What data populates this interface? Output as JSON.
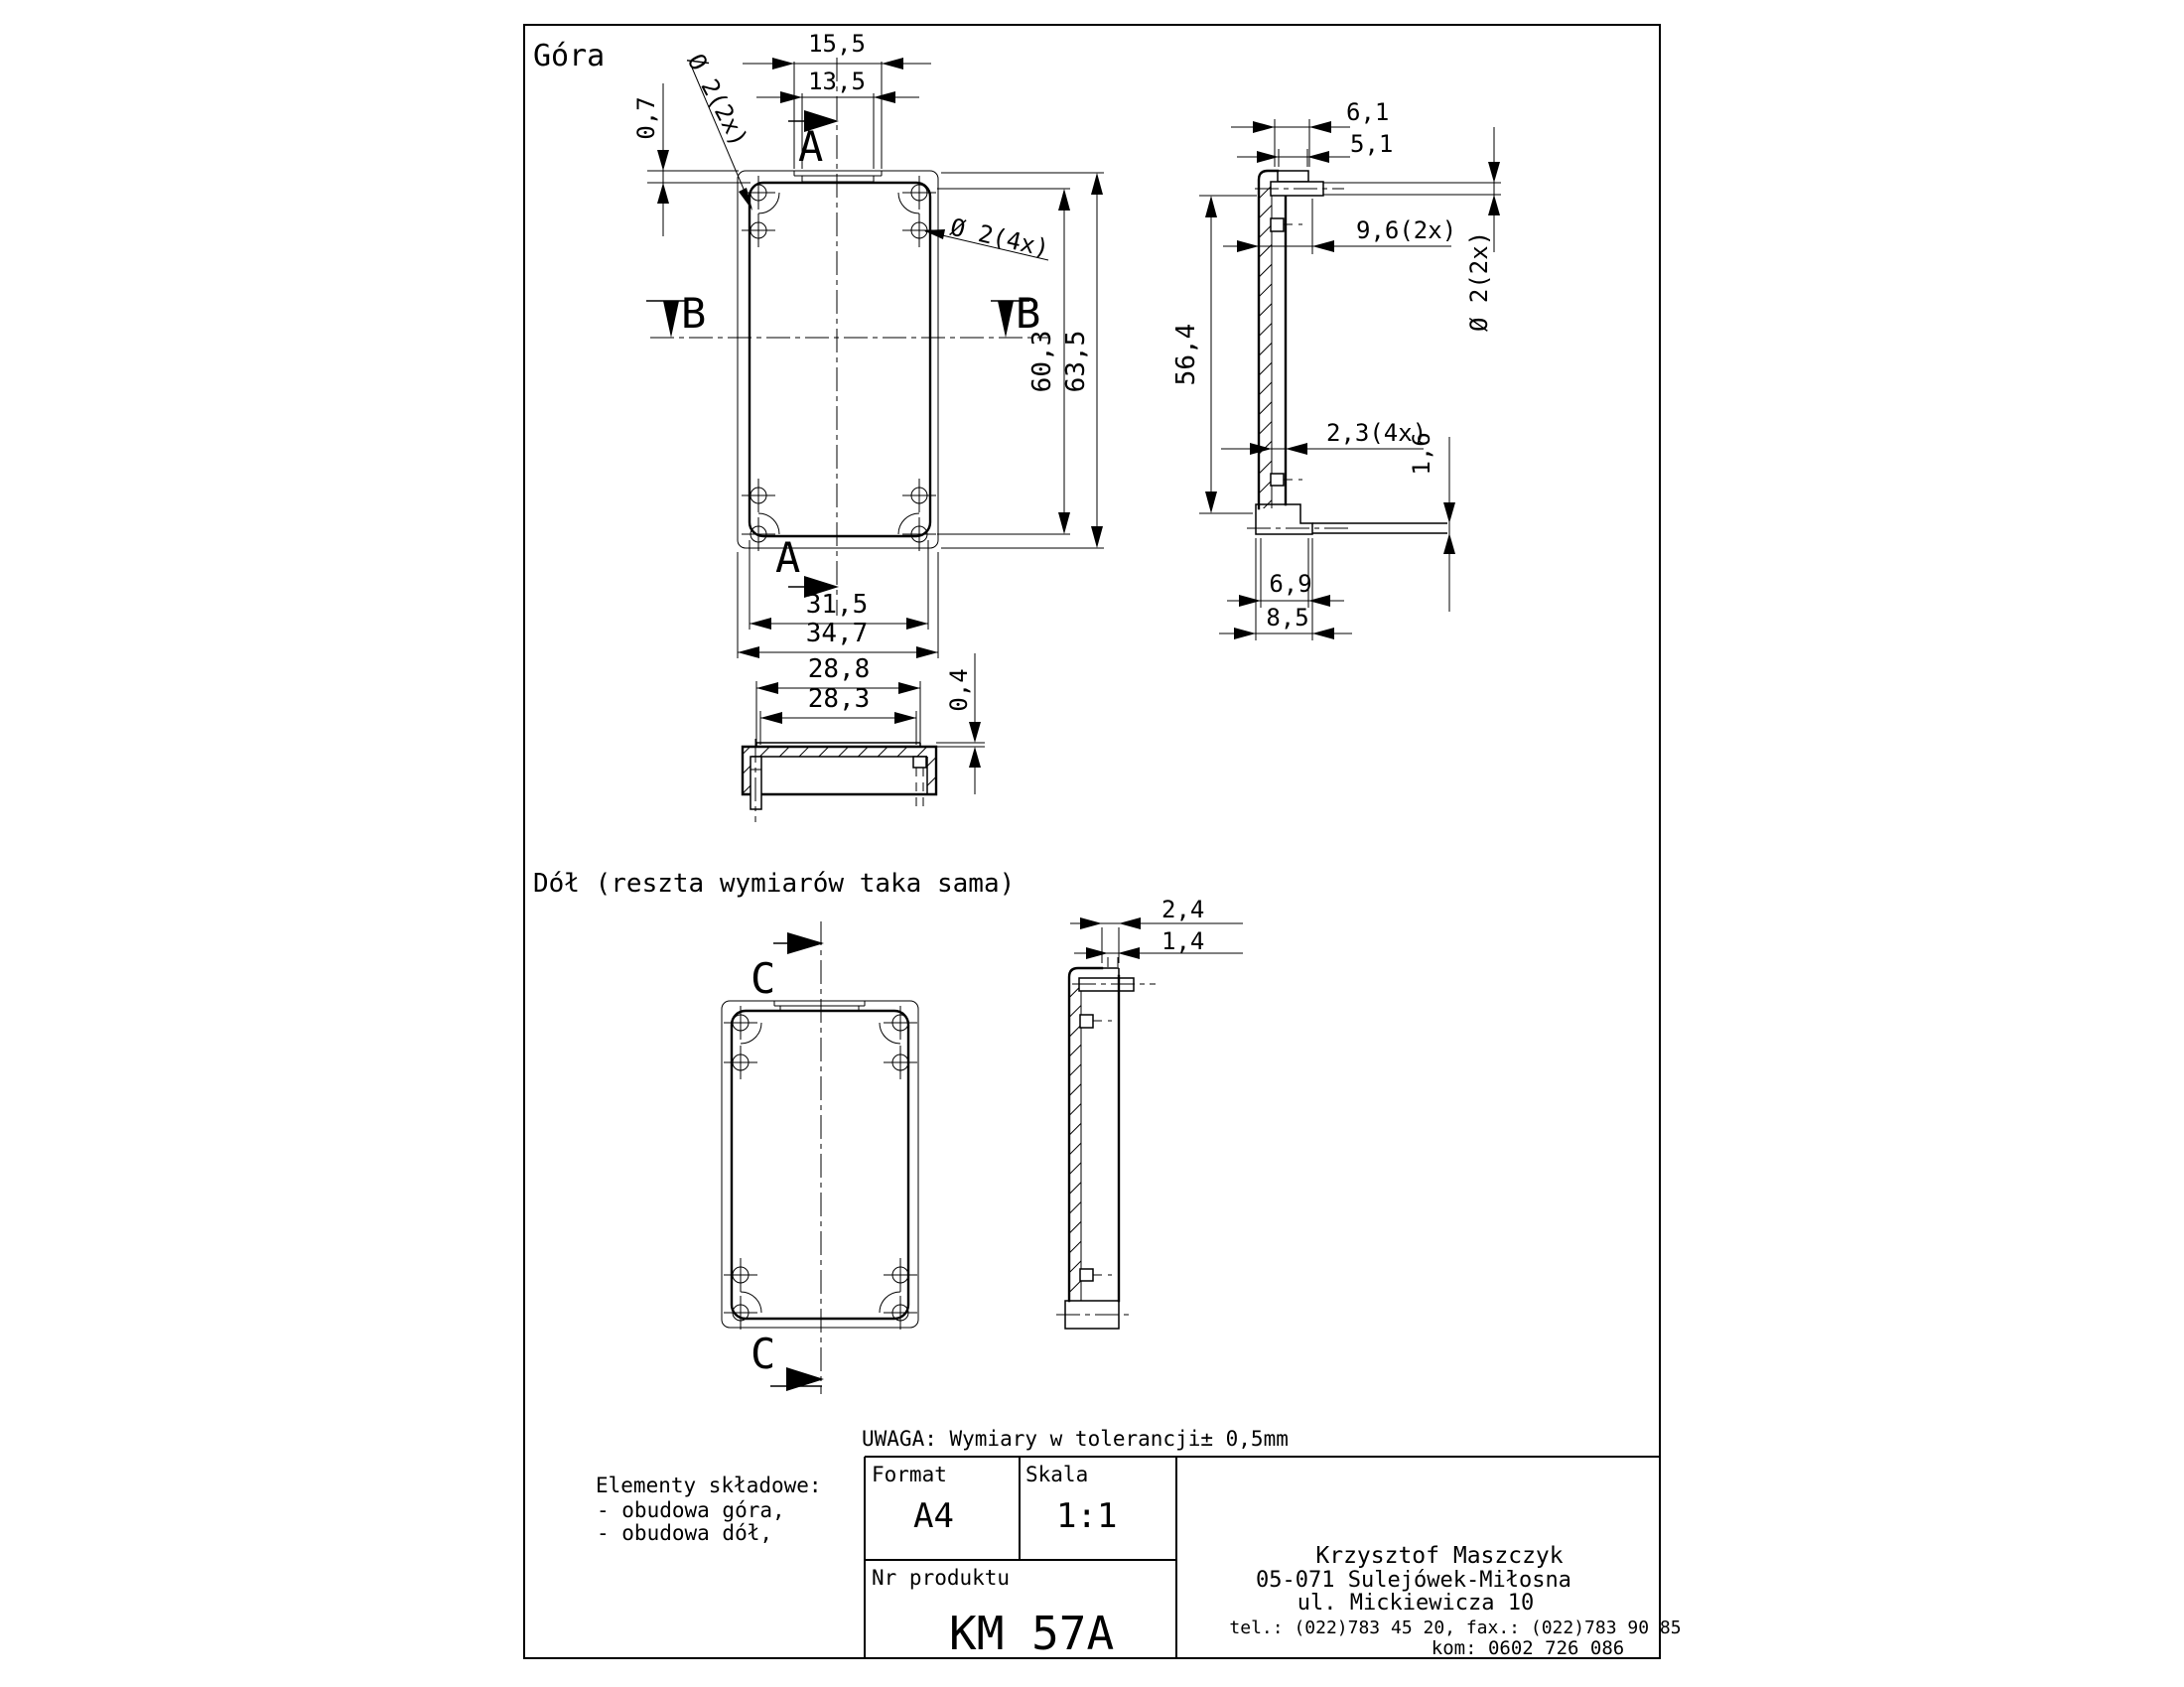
{
  "labels": {
    "top_view_title": "Góra",
    "bottom_view_title": "Dół (reszta wymiarów taka sama)",
    "tolerance_note": "UWAGA: Wymiary w tolerancji± 0,5mm"
  },
  "sections": {
    "a": "A",
    "b": "B",
    "c": "C"
  },
  "dimensions": {
    "top_view": {
      "tab_width_outer": "15,5",
      "tab_width_inner": "13,5",
      "lip_offset": "0,7",
      "holes_top": "Ø 2(2x)",
      "holes_corner": "Ø 2(4x)",
      "length_inner": "60,3",
      "length_outer": "63,5",
      "width_inner": "31,5",
      "width_outer": "34,7"
    },
    "section_b": {
      "width_top": "28,8",
      "width_bottom": "28,3",
      "step_height": "0,4"
    },
    "side_section": {
      "tab_outer": "6,1",
      "tab_inner": "5,1",
      "boss_length": "9,6(2x)",
      "stud_diameter": "Ø 2(2x)",
      "inner_height": "56,4",
      "rib_width": "2,3(4x)",
      "flange_thickness": "1,6",
      "foot_inner": "6,9",
      "foot_outer": "8,5"
    },
    "bottom_side": {
      "tab_outer": "2,4",
      "tab_inner": "1,4"
    }
  },
  "components_note": {
    "title": "Elementy składowe:",
    "items": [
      "- obudowa góra,",
      "- obudowa dół,"
    ]
  },
  "title_block": {
    "format_label": "Format",
    "format_value": "A4",
    "scale_label": "Skala",
    "scale_value": "1:1",
    "product_label": "Nr produktu",
    "product_value": "KM 57A"
  },
  "manufacturer": {
    "name": "Krzysztof Maszczyk",
    "address_line1": "05-071 Sulejówek-Miłosna",
    "address_line2": "ul. Mickiewicza 10",
    "phone_fax": "tel.: (022)783 45 20,  fax.: (022)783 90 85",
    "mobile": "kom: 0602 726 086"
  },
  "colors": {
    "line": "#000000",
    "background": "#ffffff"
  }
}
